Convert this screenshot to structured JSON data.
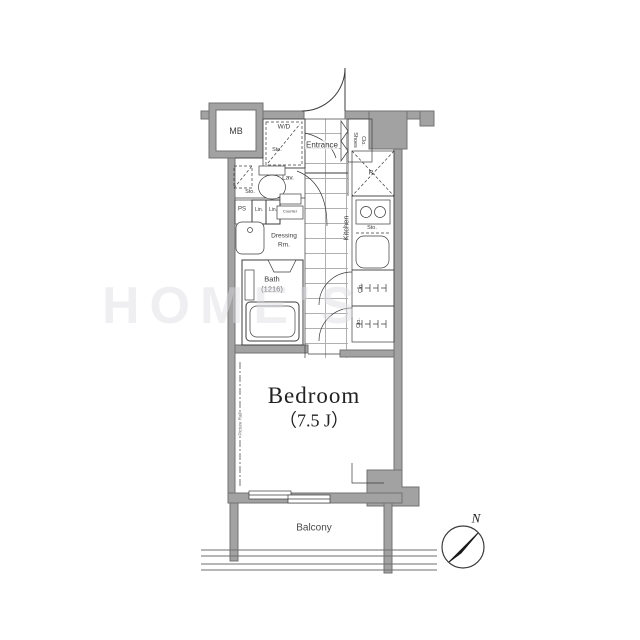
{
  "document": {
    "type": "apartment-floor-plan"
  },
  "labels": {
    "mb": "MB",
    "washer_dryer": "W/D",
    "washer_sto": "Sto.",
    "entrance": "Entrance",
    "shoes_line1": "Shoes",
    "shoes_line2": "Clo.",
    "lav": "Lav.",
    "lav_sto": "Sto.",
    "ps": "PS",
    "lin1": "Lin.",
    "lin2": "Lin.",
    "counter": "Counter",
    "dressing_line1": "Dressing",
    "dressing_line2": "Rm.",
    "bath_line1": "Bath",
    "bath_line2": "(1216)",
    "kitchen": "Kitchen",
    "refrigerator": "R.",
    "kitchen_sto": "Sto.",
    "closet1": "Clo.",
    "closet2": "Clo.",
    "picture_rail": "Picture Rail",
    "bedroom_name": "Bedroom",
    "bedroom_size": "（7.5 J）",
    "balcony": "Balcony",
    "compass_north": "N",
    "watermark": "HOME'S"
  },
  "colors": {
    "wall_fill": "#a2a2a2",
    "wall_stroke": "#737373",
    "line": "#3c3c3c",
    "tile_line": "#b0b0b0",
    "compass_needle": "#1a1a1a"
  }
}
